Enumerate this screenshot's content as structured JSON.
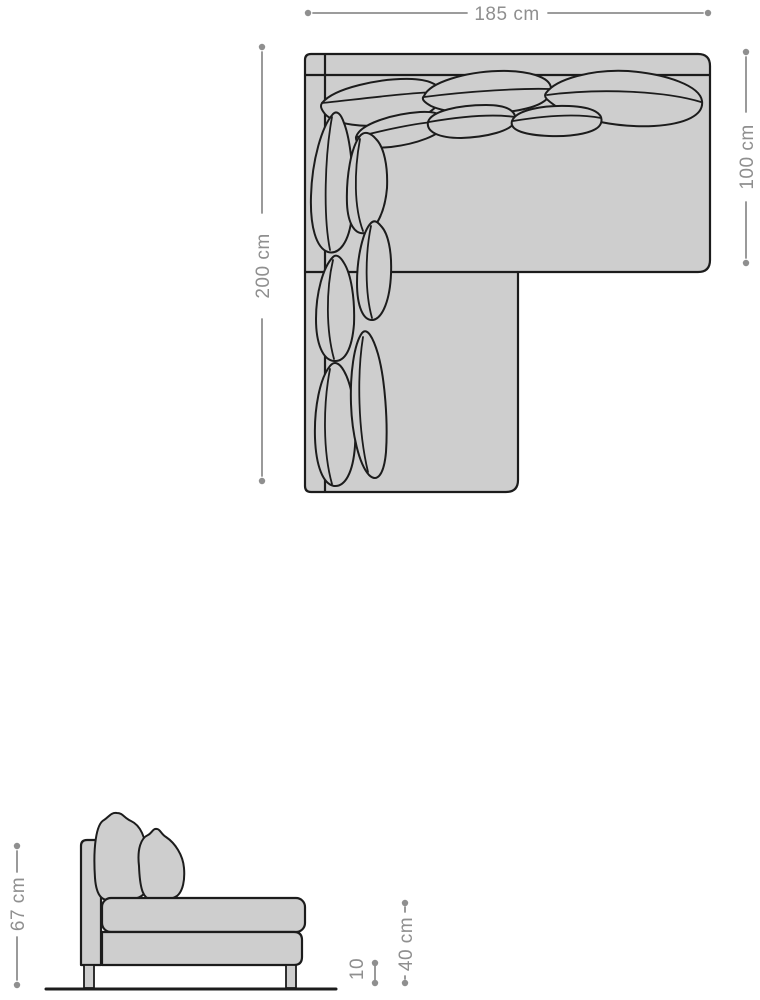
{
  "colors": {
    "background": "#ffffff",
    "sofa_fill": "#cecece",
    "sofa_outline": "#1c1c1c",
    "dim": "#8f8f8f"
  },
  "top_view": {
    "dims": {
      "width": "185 cm",
      "depth": "100 cm",
      "length": "200 cm"
    }
  },
  "side_view": {
    "dims": {
      "height": "67 cm",
      "seat_height": "40 cm",
      "leg_height": "10"
    }
  }
}
